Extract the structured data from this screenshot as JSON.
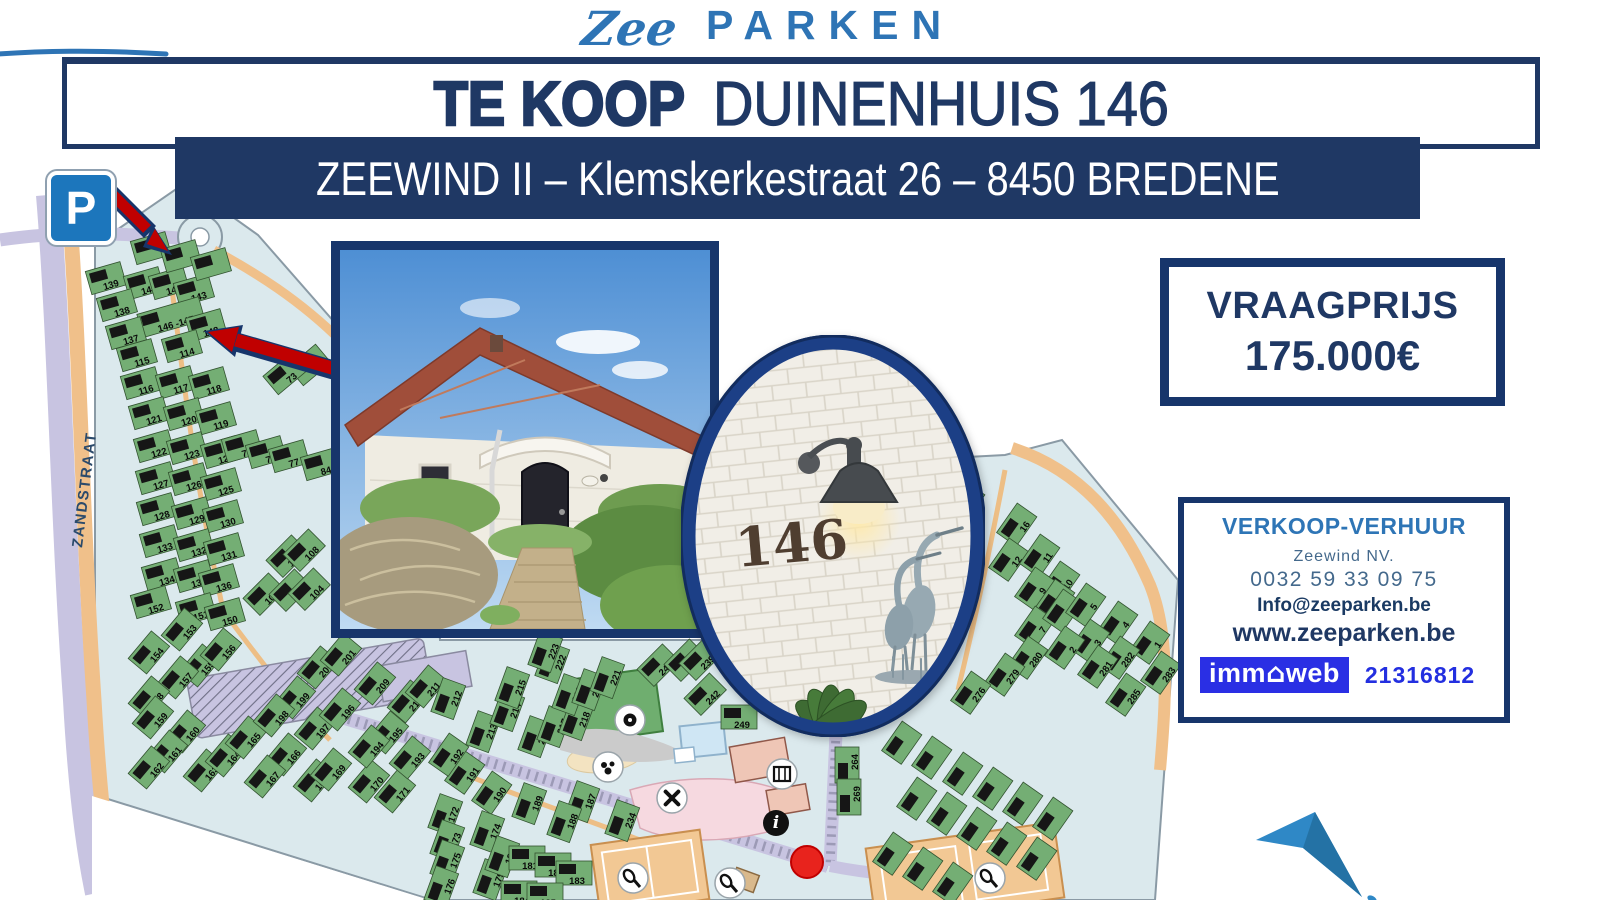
{
  "logo": {
    "script": "Zee",
    "name": "PARKEN"
  },
  "banner": {
    "sale_label": "TE KOOP",
    "property": "DUINENHUIS 146"
  },
  "subtitle": "ZEEWIND II – Klemskerkestraat 26 – 8450 BREDENE",
  "price_box": {
    "label": "VRAAGPRIJS",
    "amount": "175.000€"
  },
  "contact_box": {
    "heading": "VERKOOP-VERHUUR",
    "company": "Zeewind NV.",
    "phone": "0032 59 33 09 75",
    "email": "Info@zeeparken.be",
    "website": "www.zeeparken.be",
    "immoweb": {
      "pre": "imm",
      "house_glyph": "⌂",
      "post": "web",
      "reference": "21316812"
    }
  },
  "oval_photo": {
    "house_number": "146"
  },
  "colors": {
    "navy": "#1F3864",
    "logo_blue": "#2E74B5",
    "immoweb_blue": "#2A2FE4",
    "arrow_red": "#C00000",
    "map_green": "#74AE74",
    "road_orange": "#F0C08A",
    "street_lavender": "#C8C4E1",
    "parking_blue": "#1C76BC"
  },
  "map": {
    "street_label": "ZANDSTRAAT",
    "parking_sign": "P",
    "parcels": [
      {
        "n": "139",
        "x": 107,
        "y": 282
      },
      {
        "n": "145",
        "x": 145,
        "y": 287
      },
      {
        "n": "144",
        "x": 170,
        "y": 287
      },
      {
        "n": "143",
        "x": 195,
        "y": 294
      },
      {
        "n": "138",
        "x": 118,
        "y": 309
      },
      {
        "n": "146 -147",
        "x": 172,
        "y": 321
      },
      {
        "n": "148",
        "x": 207,
        "y": 329
      },
      {
        "n": "137",
        "x": 127,
        "y": 337
      },
      {
        "n": "114",
        "x": 183,
        "y": 350
      },
      {
        "n": "115",
        "x": 138,
        "y": 359
      },
      {
        "n": "116",
        "x": 142,
        "y": 387
      },
      {
        "n": "117",
        "x": 177,
        "y": 386
      },
      {
        "n": "118",
        "x": 210,
        "y": 387
      },
      {
        "n": "121",
        "x": 150,
        "y": 417
      },
      {
        "n": "120",
        "x": 185,
        "y": 418
      },
      {
        "n": "119",
        "x": 217,
        "y": 422
      },
      {
        "n": "122",
        "x": 155,
        "y": 450
      },
      {
        "n": "123",
        "x": 188,
        "y": 452
      },
      {
        "n": "124",
        "x": 222,
        "y": 456
      },
      {
        "n": "75",
        "x": 243,
        "y": 450
      },
      {
        "n": "76",
        "x": 267,
        "y": 456
      },
      {
        "n": "77",
        "x": 290,
        "y": 460
      },
      {
        "n": "84",
        "x": 322,
        "y": 468
      },
      {
        "n": "72",
        "x": 312,
        "y": 368,
        "r": -40
      },
      {
        "n": "73",
        "x": 287,
        "y": 377,
        "r": -40
      },
      {
        "n": "127",
        "x": 157,
        "y": 482
      },
      {
        "n": "126",
        "x": 190,
        "y": 483
      },
      {
        "n": "125",
        "x": 222,
        "y": 488
      },
      {
        "n": "128",
        "x": 158,
        "y": 513
      },
      {
        "n": "129",
        "x": 193,
        "y": 517
      },
      {
        "n": "130",
        "x": 224,
        "y": 520
      },
      {
        "n": "133",
        "x": 161,
        "y": 545
      },
      {
        "n": "132",
        "x": 195,
        "y": 549
      },
      {
        "n": "131",
        "x": 225,
        "y": 553
      },
      {
        "n": "134",
        "x": 163,
        "y": 578
      },
      {
        "n": "135",
        "x": 195,
        "y": 580
      },
      {
        "n": "136",
        "x": 220,
        "y": 584
      },
      {
        "n": "152",
        "x": 152,
        "y": 606
      },
      {
        "n": "151",
        "x": 197,
        "y": 613
      },
      {
        "n": "150",
        "x": 226,
        "y": 618
      },
      {
        "n": "107",
        "x": 290,
        "y": 559,
        "r": -45
      },
      {
        "n": "108",
        "x": 307,
        "y": 553,
        "r": -45
      },
      {
        "n": "106",
        "x": 267,
        "y": 597,
        "r": -45
      },
      {
        "n": "105",
        "x": 293,
        "y": 593,
        "r": -45
      },
      {
        "n": "104",
        "x": 312,
        "y": 592,
        "r": -45
      },
      {
        "n": "153",
        "x": 185,
        "y": 632,
        "r": -50
      },
      {
        "n": "154",
        "x": 152,
        "y": 655,
        "r": -50
      },
      {
        "n": "155",
        "x": 203,
        "y": 668,
        "r": -50
      },
      {
        "n": "156",
        "x": 224,
        "y": 652,
        "r": -50
      },
      {
        "n": "157",
        "x": 181,
        "y": 680,
        "r": -50
      },
      {
        "n": "158",
        "x": 152,
        "y": 700,
        "r": -50
      },
      {
        "n": "159",
        "x": 156,
        "y": 720,
        "r": -50
      },
      {
        "n": "160",
        "x": 188,
        "y": 734,
        "r": -50
      },
      {
        "n": "161",
        "x": 170,
        "y": 754,
        "r": -50
      },
      {
        "n": "162",
        "x": 152,
        "y": 770,
        "r": -50
      },
      {
        "n": "163",
        "x": 207,
        "y": 773,
        "r": -50
      },
      {
        "n": "164",
        "x": 229,
        "y": 758,
        "r": -50
      },
      {
        "n": "165",
        "x": 249,
        "y": 740,
        "r": -50
      },
      {
        "n": "166",
        "x": 289,
        "y": 757,
        "r": -50
      },
      {
        "n": "167",
        "x": 268,
        "y": 779,
        "r": -50
      },
      {
        "n": "168",
        "x": 317,
        "y": 783,
        "r": -50
      },
      {
        "n": "169",
        "x": 334,
        "y": 772,
        "r": -50
      },
      {
        "n": "170",
        "x": 372,
        "y": 784,
        "r": -50
      },
      {
        "n": "171",
        "x": 398,
        "y": 794,
        "r": -50
      },
      {
        "n": "199",
        "x": 298,
        "y": 700,
        "r": -50
      },
      {
        "n": "198",
        "x": 277,
        "y": 718,
        "r": -50
      },
      {
        "n": "197",
        "x": 318,
        "y": 731,
        "r": -50
      },
      {
        "n": "196",
        "x": 343,
        "y": 712,
        "r": -50
      },
      {
        "n": "195",
        "x": 391,
        "y": 735,
        "r": -50
      },
      {
        "n": "194",
        "x": 372,
        "y": 749,
        "r": -50
      },
      {
        "n": "193",
        "x": 413,
        "y": 760,
        "r": -50
      },
      {
        "n": "200",
        "x": 321,
        "y": 670,
        "r": -50
      },
      {
        "n": "201",
        "x": 344,
        "y": 657,
        "r": -50
      },
      {
        "n": "209",
        "x": 378,
        "y": 686,
        "r": -50
      },
      {
        "n": "210",
        "x": 411,
        "y": 704,
        "r": -50
      },
      {
        "n": "211",
        "x": 429,
        "y": 689,
        "r": -50
      },
      {
        "n": "190",
        "x": 495,
        "y": 795,
        "r": -55
      },
      {
        "n": "191",
        "x": 468,
        "y": 775,
        "r": -55
      },
      {
        "n": "192",
        "x": 452,
        "y": 757,
        "r": -55
      },
      {
        "n": "172",
        "x": 449,
        "y": 816,
        "r": -70
      },
      {
        "n": "173",
        "x": 451,
        "y": 842,
        "r": -70
      },
      {
        "n": "174",
        "x": 491,
        "y": 833,
        "r": -70
      },
      {
        "n": "175",
        "x": 451,
        "y": 862,
        "r": -70
      },
      {
        "n": "176",
        "x": 445,
        "y": 888,
        "r": -70
      },
      {
        "n": "179",
        "x": 494,
        "y": 881,
        "r": -70
      },
      {
        "n": "180",
        "x": 506,
        "y": 858,
        "r": -70
      },
      {
        "n": "181",
        "x": 527,
        "y": 862,
        "r": 0
      },
      {
        "n": "182",
        "x": 553,
        "y": 869,
        "r": 0
      },
      {
        "n": "183",
        "x": 574,
        "y": 877,
        "r": 0
      },
      {
        "n": "184",
        "x": 519,
        "y": 897,
        "r": 0
      },
      {
        "n": "185",
        "x": 545,
        "y": 899,
        "r": 0
      },
      {
        "n": "189",
        "x": 533,
        "y": 805,
        "r": -70
      },
      {
        "n": "187",
        "x": 586,
        "y": 803,
        "r": -70
      },
      {
        "n": "188",
        "x": 568,
        "y": 823,
        "r": -70
      },
      {
        "n": "234",
        "x": 626,
        "y": 822,
        "r": -70
      },
      {
        "n": "212",
        "x": 452,
        "y": 700,
        "r": -70
      },
      {
        "n": "213",
        "x": 487,
        "y": 733,
        "r": -70
      },
      {
        "n": "214",
        "x": 511,
        "y": 712,
        "r": -70
      },
      {
        "n": "215",
        "x": 516,
        "y": 689,
        "r": -70
      },
      {
        "n": "216",
        "x": 539,
        "y": 738,
        "r": -70
      },
      {
        "n": "217",
        "x": 558,
        "y": 728,
        "r": -70
      },
      {
        "n": "218",
        "x": 580,
        "y": 721,
        "r": -70
      },
      {
        "n": "219",
        "x": 573,
        "y": 696,
        "r": -70
      },
      {
        "n": "220",
        "x": 593,
        "y": 691,
        "r": -70
      },
      {
        "n": "221",
        "x": 611,
        "y": 679,
        "r": -70
      },
      {
        "n": "222",
        "x": 556,
        "y": 664,
        "r": -70
      },
      {
        "n": "223",
        "x": 549,
        "y": 653,
        "r": -70
      },
      {
        "n": "243",
        "x": 661,
        "y": 668,
        "r": -45
      },
      {
        "n": "240",
        "x": 688,
        "y": 663,
        "r": -45
      },
      {
        "n": "239",
        "x": 703,
        "y": 662,
        "r": -45
      },
      {
        "n": "242",
        "x": 708,
        "y": 697,
        "r": -45
      },
      {
        "n": "249",
        "x": 739,
        "y": 721,
        "r": 0
      },
      {
        "n": "264",
        "x": 851,
        "y": 765,
        "r": -90
      },
      {
        "n": "269",
        "x": 853,
        "y": 797,
        "r": -90
      },
      {
        "n": "16",
        "x": 1020,
        "y": 527,
        "r": -55
      },
      {
        "n": "12",
        "x": 1012,
        "y": 562,
        "r": -55
      },
      {
        "n": "11",
        "x": 1043,
        "y": 558,
        "r": -55
      },
      {
        "n": "10",
        "x": 1063,
        "y": 585,
        "r": -55
      },
      {
        "n": "9",
        "x": 1038,
        "y": 591,
        "r": -55
      },
      {
        "n": "8",
        "x": 1058,
        "y": 603,
        "r": -55
      },
      {
        "n": "7",
        "x": 1038,
        "y": 630,
        "r": -55
      },
      {
        "n": "6",
        "x": 1066,
        "y": 613,
        "r": -55
      },
      {
        "n": "5",
        "x": 1089,
        "y": 607,
        "r": -55
      },
      {
        "n": "4",
        "x": 1121,
        "y": 625,
        "r": -55
      },
      {
        "n": "3",
        "x": 1093,
        "y": 643,
        "r": -55
      },
      {
        "n": "2",
        "x": 1068,
        "y": 650,
        "r": -55
      },
      {
        "n": "1",
        "x": 1153,
        "y": 645,
        "r": -55
      },
      {
        "n": "282",
        "x": 1123,
        "y": 660,
        "r": -55
      },
      {
        "n": "281",
        "x": 1101,
        "y": 669,
        "r": -55
      },
      {
        "n": "280",
        "x": 1031,
        "y": 660,
        "r": -55
      },
      {
        "n": "279",
        "x": 1008,
        "y": 677,
        "r": -55
      },
      {
        "n": "276",
        "x": 974,
        "y": 695,
        "r": -55
      },
      {
        "n": "283",
        "x": 1164,
        "y": 675,
        "r": -55
      },
      {
        "n": "285",
        "x": 1129,
        "y": 697,
        "r": -55
      },
      {
        "n": "",
        "x": 905,
        "y": 745,
        "r": -55
      },
      {
        "n": "",
        "x": 935,
        "y": 760,
        "r": -55
      },
      {
        "n": "",
        "x": 966,
        "y": 776,
        "r": -55
      },
      {
        "n": "",
        "x": 996,
        "y": 791,
        "r": -55
      },
      {
        "n": "",
        "x": 1026,
        "y": 806,
        "r": -55
      },
      {
        "n": "",
        "x": 1056,
        "y": 821,
        "r": -55
      },
      {
        "n": "",
        "x": 920,
        "y": 801,
        "r": -55
      },
      {
        "n": "",
        "x": 950,
        "y": 816,
        "r": -55
      },
      {
        "n": "",
        "x": 980,
        "y": 831,
        "r": -55
      },
      {
        "n": "",
        "x": 1010,
        "y": 846,
        "r": -55
      },
      {
        "n": "",
        "x": 1040,
        "y": 861,
        "r": -55
      },
      {
        "n": "",
        "x": 896,
        "y": 856,
        "r": -55
      },
      {
        "n": "",
        "x": 926,
        "y": 871,
        "r": -55
      },
      {
        "n": "",
        "x": 956,
        "y": 886,
        "r": -55
      },
      {
        "n": "",
        "x": 152,
        "y": 252
      },
      {
        "n": "",
        "x": 182,
        "y": 260
      },
      {
        "n": "",
        "x": 212,
        "y": 268
      },
      {
        "n": "",
        "x": 968,
        "y": 505,
        "r": -55
      },
      {
        "n": "",
        "x": 948,
        "y": 522,
        "r": -55
      }
    ],
    "amenities": [
      {
        "t": "soccer",
        "x": 630,
        "y": 720
      },
      {
        "t": "pond",
        "x": 608,
        "y": 767
      },
      {
        "t": "food",
        "x": 672,
        "y": 798
      },
      {
        "t": "shop",
        "x": 782,
        "y": 774
      },
      {
        "t": "info",
        "x": 776,
        "y": 823
      },
      {
        "t": "tennis",
        "x": 633,
        "y": 878
      },
      {
        "t": "tennis",
        "x": 730,
        "y": 883
      },
      {
        "t": "tennis",
        "x": 990,
        "y": 878
      }
    ]
  }
}
